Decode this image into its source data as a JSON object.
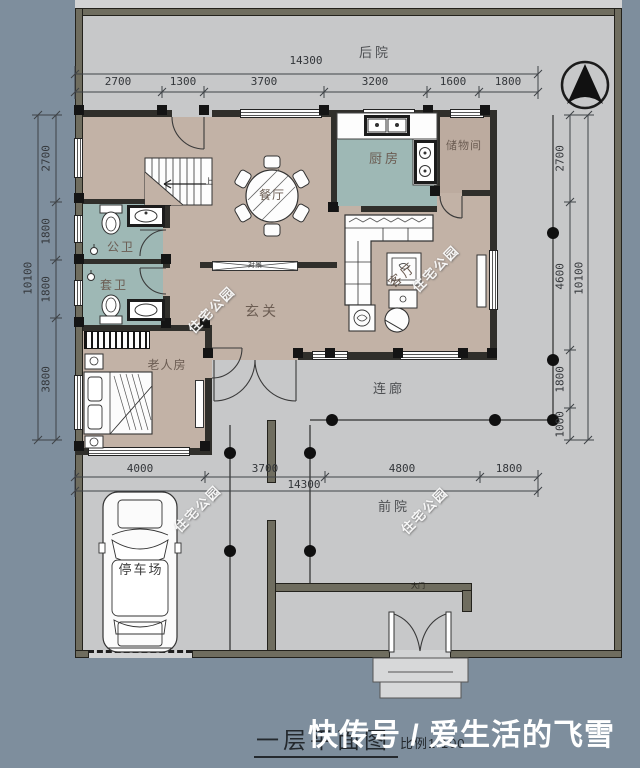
{
  "title_block": {
    "title": "一层平面图",
    "scale": "比例1:100",
    "overlay_watermark": "快传号 / 爱生活的飞雪"
  },
  "watermark": {
    "text": "住宅公园"
  },
  "rooms": {
    "backyard": "后院",
    "front_yard": "前院",
    "corridor": "连廊",
    "parking_lot": "停车场",
    "entry_hall": "玄关",
    "dining_room": "餐厅",
    "kitchen": "厨房",
    "storage_room": "储物间",
    "living_room": "客厅",
    "public_bathroom": "公卫",
    "ensuite_bathroom": "套卫",
    "elder_bedroom": "老人房",
    "feature_cabinet": "对景",
    "stairs_up": "上",
    "main_gate": "大门"
  },
  "dimensions": {
    "top": {
      "total": "14300",
      "segments": [
        "2700",
        "1300",
        "3700",
        "3200",
        "1600",
        "1800"
      ]
    },
    "bottom": {
      "total": "14300",
      "segments": [
        "4000",
        "3700",
        "4800",
        "1800"
      ]
    },
    "left": {
      "total": "10100",
      "segments": [
        "2700",
        "1800",
        "1800",
        "3800"
      ]
    },
    "right": {
      "total": "10100",
      "segments": [
        "2700",
        "4600",
        "1800",
        "1000"
      ]
    }
  },
  "colors": {
    "background": "#7e8e9d",
    "paper": "#d2d3d4",
    "courtyard": "#c7c8c9",
    "floor_beige": "#c2b2a6",
    "floor_teal": "#9eb8b5",
    "wall_dark": "#302f2b",
    "wall_olive": "#6f6d5f"
  }
}
